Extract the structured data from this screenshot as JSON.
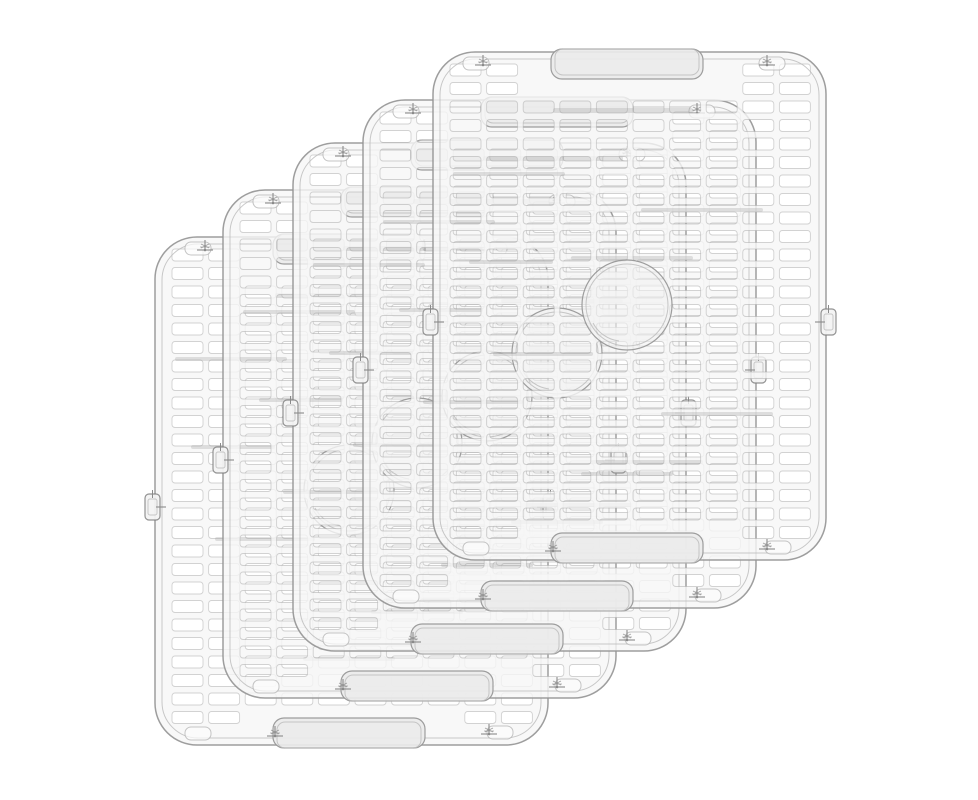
{
  "scene": {
    "name": "stack of five clear plastic sink protector grid mats",
    "background_color": "#ffffff",
    "mat_count": 5
  },
  "colors": {
    "background": "#ffffff",
    "sheet_fill": "rgba(246,246,246,0.80)",
    "frame_outer": "rgba(148,148,148,0.90)",
    "frame_inner": "rgba(186,186,186,0.80)",
    "slot_stroke": "rgba(168,168,168,0.50)",
    "handle_fill": "rgba(234,234,234,0.92)",
    "drain_fill": "rgba(242,242,242,0.60)",
    "reflection": "rgba(158,158,158,0.30)",
    "hardware": "#8a8a8a",
    "pocket_stroke": "rgba(178,178,178,0.75)",
    "pocket_fill": "rgba(252,252,252,0.70)",
    "tab_fill": "rgba(243,243,243,0.95)",
    "tab_stroke": "rgba(128,128,128,0.85)"
  },
  "mat": {
    "width": 393,
    "height": 508,
    "radius": 42,
    "inner_inset": 7,
    "inner_radius": 36,
    "grid": {
      "cols": 10,
      "rows": 26,
      "x0": 17,
      "y0": 12,
      "pitch_x": 36.6,
      "pitch_y": 18.5,
      "slot_w": 31,
      "slot_h": 12,
      "slot_r": 3
    },
    "handle": {
      "x": 118,
      "w": 152,
      "depth": 27,
      "r": 11,
      "inner_inset": 4
    },
    "drain": {
      "cx": 194,
      "cy": 253,
      "r": 45,
      "r_inner": 41
    },
    "offsets_back_to_front": [
      [
        155,
        237
      ],
      [
        223,
        190
      ],
      [
        293,
        143
      ],
      [
        363,
        100
      ],
      [
        433,
        52
      ]
    ],
    "feet": [
      [
        50,
        10
      ],
      [
        334,
        10
      ],
      [
        120,
        496
      ],
      [
        334,
        494
      ]
    ],
    "pockets": [
      [
        30,
        5
      ],
      [
        326,
        5
      ],
      [
        30,
        490
      ],
      [
        332,
        489
      ]
    ],
    "side_tab": {
      "y": 257,
      "w": 15,
      "h": 26
    },
    "reflections": [
      [
        120,
        56,
        140,
        5
      ],
      [
        20,
        120,
        112,
        4
      ],
      [
        208,
        156,
        122,
        4
      ],
      [
        60,
        300,
        100,
        4
      ],
      [
        228,
        360,
        112,
        4
      ],
      [
        148,
        420,
        92,
        4
      ],
      [
        36,
        208,
        84,
        4
      ]
    ]
  }
}
